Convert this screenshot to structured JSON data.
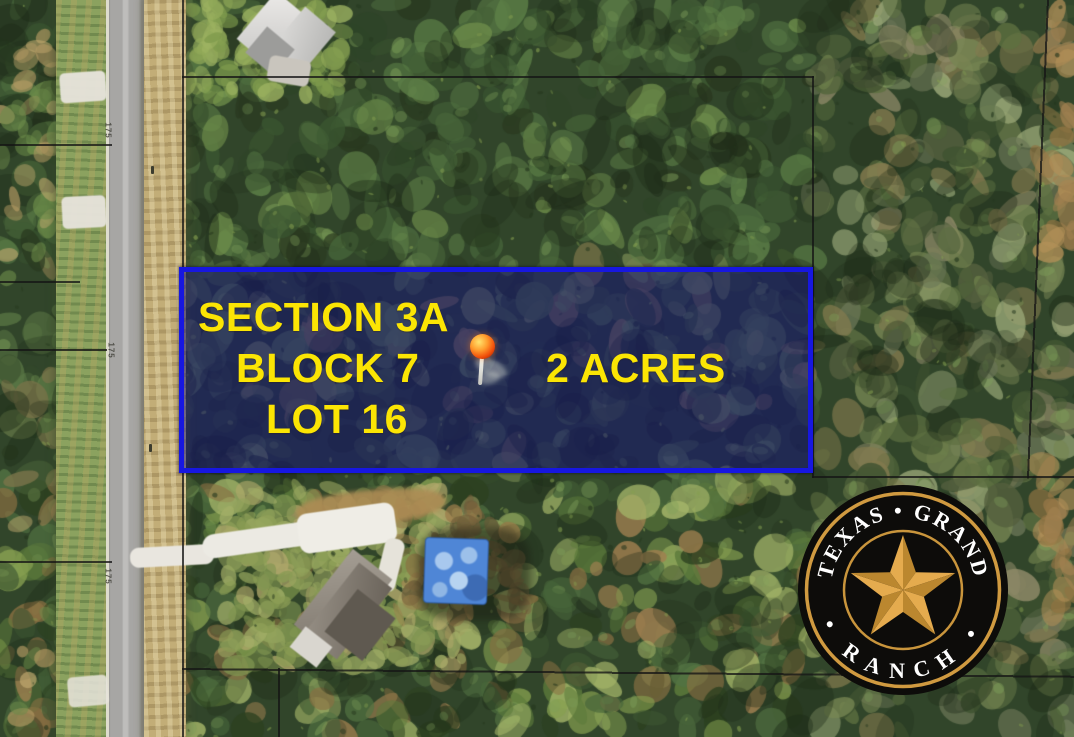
{
  "map_overlay": {
    "section_label": "SECTION 3A",
    "block_label": "BLOCK 7",
    "lot_label": "LOT 16",
    "acreage_label": "2 ACRES"
  },
  "road_dimension_labels": [
    "175",
    "175",
    "175"
  ],
  "logo": {
    "arc_top": "TEXAS • GRAND",
    "arc_bottom": "• RANCH •"
  },
  "icons": {
    "location_pin": "glossy-red-pushpin-marker",
    "ranch_star": "five-point-faceted-texas-star"
  },
  "colors": {
    "lot_border_blue": "#1717e0",
    "lot_fill_navy": "rgba(20,17,118,0.52)",
    "label_yellow": "#fbe504",
    "logo_gold": "#d09a40",
    "logo_black": "#0d0c0a",
    "star_gold_light": "#e5ab4e",
    "star_gold_dark": "#bb872f",
    "pin_red": "#f04e0a"
  }
}
